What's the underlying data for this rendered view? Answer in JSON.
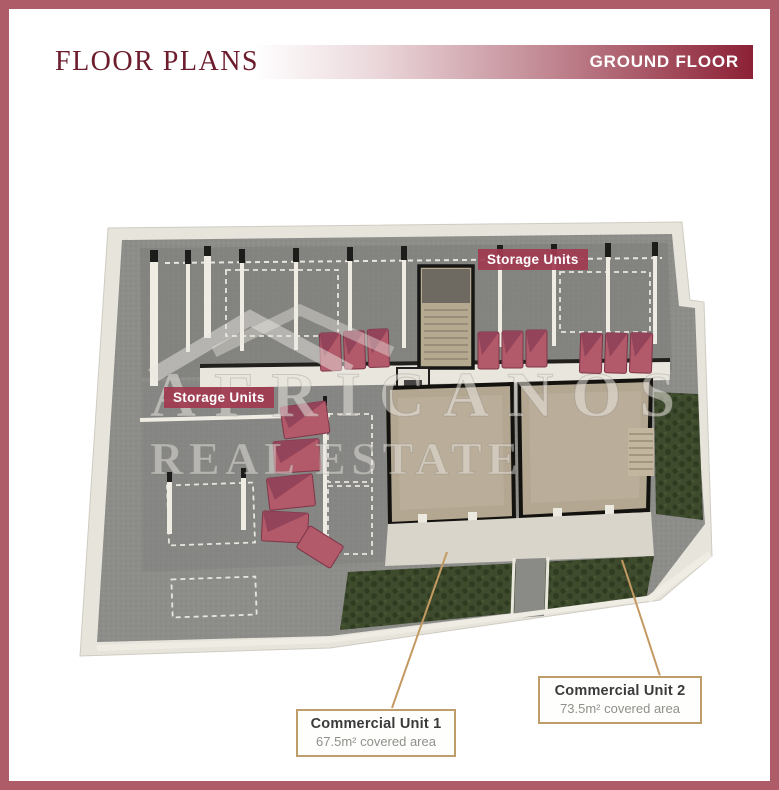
{
  "header": {
    "title": "FLOOR PLANS",
    "floor_badge": "GROUND FLOOR"
  },
  "watermark": {
    "line1": "AFRICANOS",
    "line2": "REAL ESTATE"
  },
  "plan_labels": {
    "storage_top": "Storage Units",
    "storage_left": "Storage Units"
  },
  "units": [
    {
      "name": "Commercial Unit 1",
      "area": "67.5m² covered area"
    },
    {
      "name": "Commercial Unit 2",
      "area": "73.5m² covered area"
    }
  ],
  "colors": {
    "accent": "#8c2135",
    "page-border": "#ae5d68",
    "label-bg": "#a13a50",
    "leader": "#c49a62",
    "card-border": "#bf9d6a",
    "title-color": "#6c1c2d"
  }
}
